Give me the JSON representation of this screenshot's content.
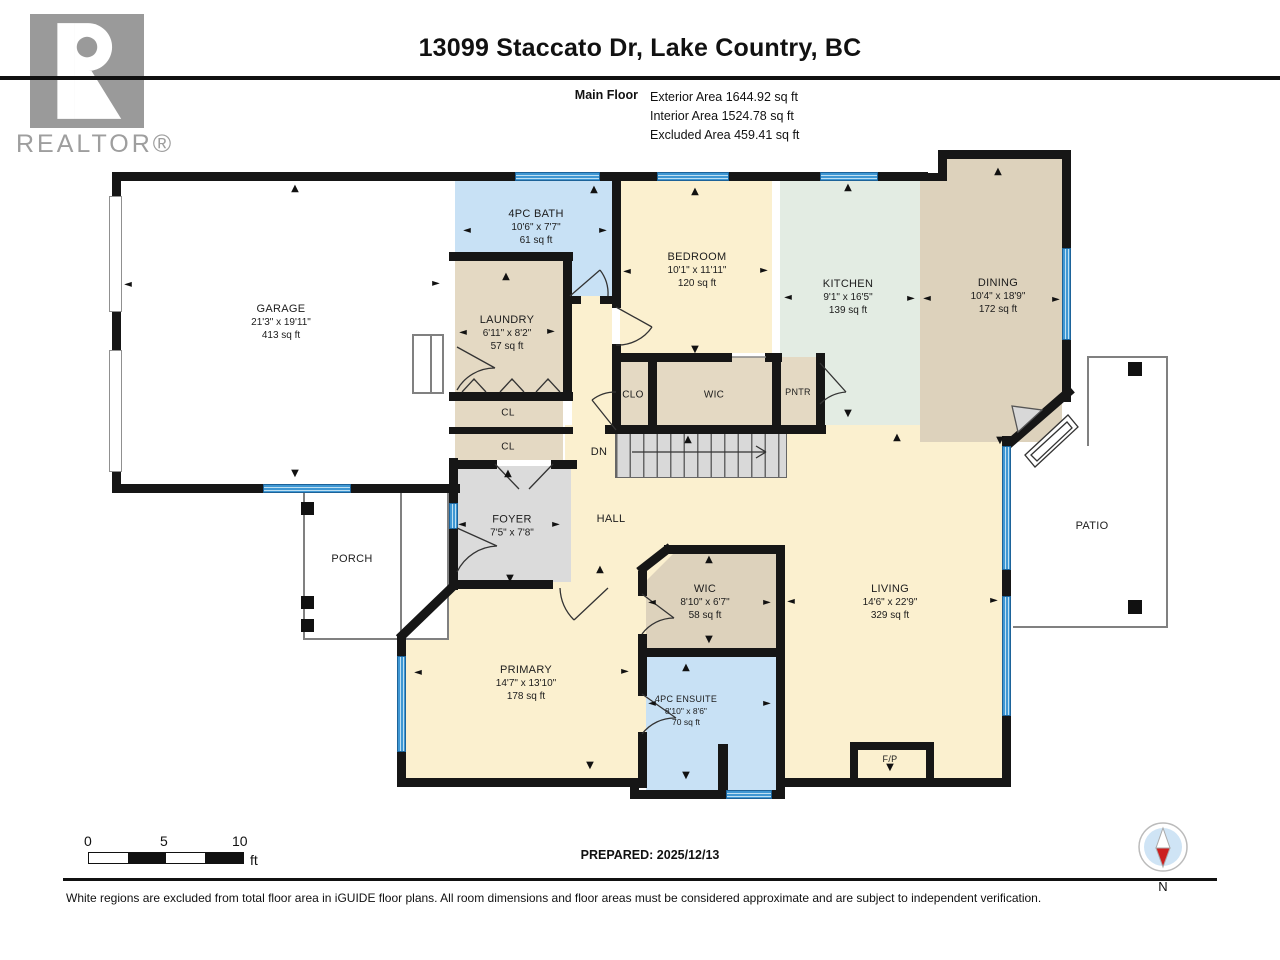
{
  "header": {
    "title": "13099 Staccato Dr, Lake Country, BC",
    "floor_label": "Main Floor",
    "area_lines": [
      "Exterior Area 1644.92 sq ft",
      "Interior Area 1524.78 sq ft",
      "Excluded Area 459.41 sq ft"
    ]
  },
  "branding": {
    "logo_text": "REALTOR®"
  },
  "rooms": {
    "garage": {
      "name": "GARAGE",
      "dims": "21'3\" x 19'11\"",
      "area": "413 sq ft"
    },
    "bath": {
      "name": "4PC BATH",
      "dims": "10'6\" x 7'7\"",
      "area": "61 sq ft"
    },
    "laundry": {
      "name": "LAUNDRY",
      "dims": "6'11\" x 8'2\"",
      "area": "57 sq ft"
    },
    "bedroom": {
      "name": "BEDROOM",
      "dims": "10'1\" x 11'11\"",
      "area": "120 sq ft"
    },
    "kitchen": {
      "name": "KITCHEN",
      "dims": "9'1\" x 16'5\"",
      "area": "139 sq ft"
    },
    "dining": {
      "name": "DINING",
      "dims": "10'4\" x 18'9\"",
      "area": "172 sq ft"
    },
    "clo": {
      "name": "CLO"
    },
    "wic_bedroom": {
      "name": "WIC"
    },
    "pntr": {
      "name": "PNTR"
    },
    "cl_upper": {
      "name": "CL"
    },
    "cl_lower": {
      "name": "CL"
    },
    "stairs": {
      "name": "DN"
    },
    "foyer": {
      "name": "FOYER",
      "dims": "7'5\" x 7'8\""
    },
    "hall": {
      "name": "HALL"
    },
    "porch": {
      "name": "PORCH"
    },
    "primary": {
      "name": "PRIMARY",
      "dims": "14'7\" x 13'10\"",
      "area": "178 sq ft"
    },
    "wic_primary": {
      "name": "WIC",
      "dims": "8'10\" x 6'7\"",
      "area": "58 sq ft"
    },
    "ensuite": {
      "name": "4PC ENSUITE",
      "dims": "8'10\" x 8'6\"",
      "area": "70 sq ft"
    },
    "living": {
      "name": "LIVING",
      "dims": "14'6\" x 22'9\"",
      "area": "329 sq ft"
    },
    "patio": {
      "name": "PATIO"
    },
    "fireplace": {
      "name": "F/P"
    }
  },
  "scale_bar": {
    "tick_0": "0",
    "tick_5": "5",
    "tick_10": "10",
    "unit": "ft"
  },
  "prepared": "PREPARED: 2025/12/13",
  "compass": {
    "north_label": "N"
  },
  "footer": {
    "disclaimer": "White regions are excluded from total floor area in iGUIDE floor plans. All room dimensions and floor areas must be considered approximate and are subject to independent verification."
  },
  "colors": {
    "wall": "#161616",
    "window": "#4aa2da",
    "room_cream": "#fbf0cf",
    "room_tan": "#e4d9c3",
    "room_tan_dark": "#ddd2bc",
    "room_blue": "#c8e1f5",
    "room_green": "#e3ece3",
    "room_gray": "#dbdbdb",
    "excluded_white": "#ffffff"
  }
}
